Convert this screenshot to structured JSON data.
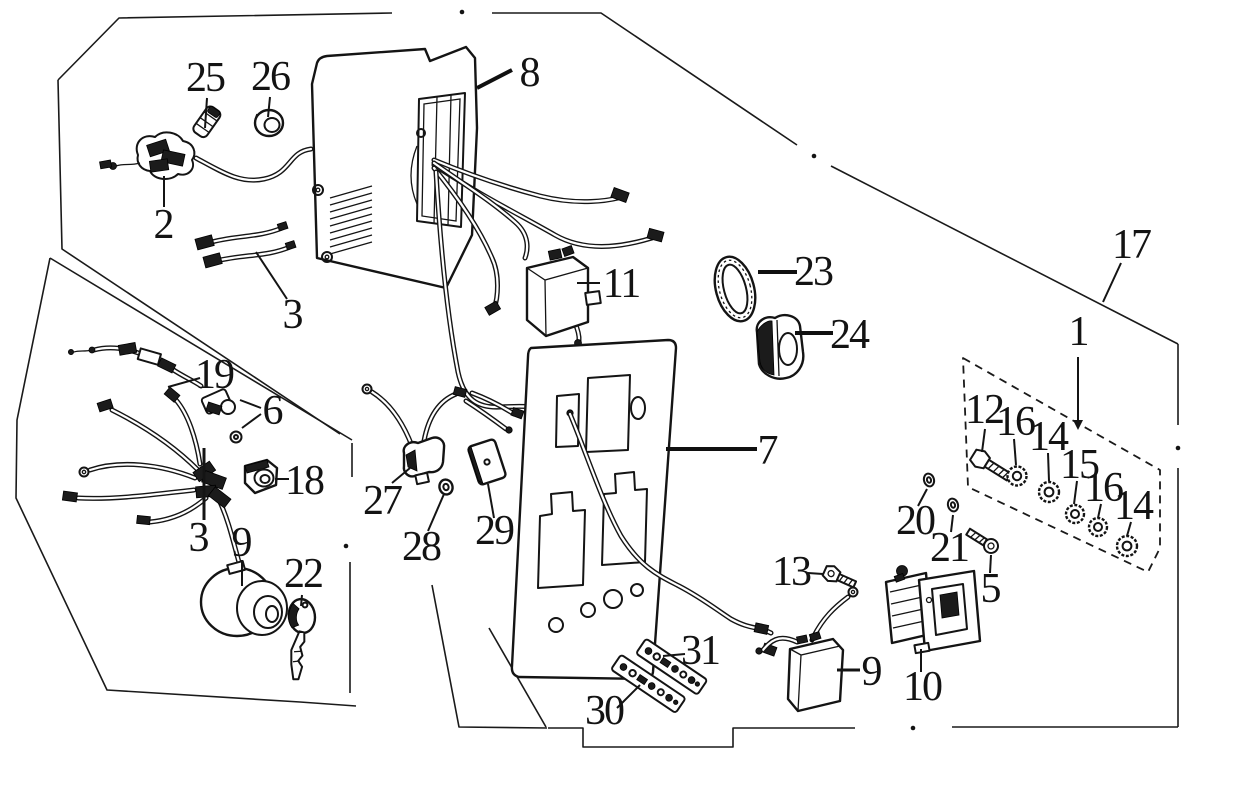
{
  "diagram": {
    "background": "#ffffff",
    "ink": "#141414",
    "callouts": [
      {
        "label": "2",
        "x": 163,
        "y": 238
      },
      {
        "label": "3",
        "x": 292,
        "y": 328
      },
      {
        "label": "25",
        "x": 205,
        "y": 91
      },
      {
        "label": "26",
        "x": 270,
        "y": 90
      },
      {
        "label": "8",
        "x": 529,
        "y": 86
      },
      {
        "label": "11",
        "x": 621,
        "y": 297
      },
      {
        "label": "23",
        "x": 813,
        "y": 285
      },
      {
        "label": "24",
        "x": 849,
        "y": 348
      },
      {
        "label": "17",
        "x": 1131,
        "y": 258
      },
      {
        "label": "1",
        "x": 1078,
        "y": 345
      },
      {
        "label": "19",
        "x": 214,
        "y": 388
      },
      {
        "label": "6",
        "x": 272,
        "y": 424
      },
      {
        "label": "18",
        "x": 304,
        "y": 494
      },
      {
        "label": "27",
        "x": 382,
        "y": 514
      },
      {
        "label": "28",
        "x": 421,
        "y": 560
      },
      {
        "label": "29",
        "x": 494,
        "y": 544
      },
      {
        "label": "3",
        "x": 198,
        "y": 551
      },
      {
        "label": "9",
        "x": 241,
        "y": 556
      },
      {
        "label": "22",
        "x": 303,
        "y": 587
      },
      {
        "label": "7",
        "x": 767,
        "y": 464
      },
      {
        "label": "13",
        "x": 791,
        "y": 585
      },
      {
        "label": "31",
        "x": 700,
        "y": 664
      },
      {
        "label": "30",
        "x": 604,
        "y": 724
      },
      {
        "label": "9",
        "x": 871,
        "y": 685
      },
      {
        "label": "10",
        "x": 922,
        "y": 700
      },
      {
        "label": "12",
        "x": 984,
        "y": 423
      },
      {
        "label": "16",
        "x": 1015,
        "y": 435
      },
      {
        "label": "14",
        "x": 1048,
        "y": 450
      },
      {
        "label": "15",
        "x": 1079,
        "y": 478
      },
      {
        "label": "16",
        "x": 1103,
        "y": 501
      },
      {
        "label": "14",
        "x": 1133,
        "y": 519
      },
      {
        "label": "20",
        "x": 915,
        "y": 534
      },
      {
        "label": "21",
        "x": 949,
        "y": 561
      },
      {
        "label": "5",
        "x": 990,
        "y": 602
      }
    ]
  }
}
